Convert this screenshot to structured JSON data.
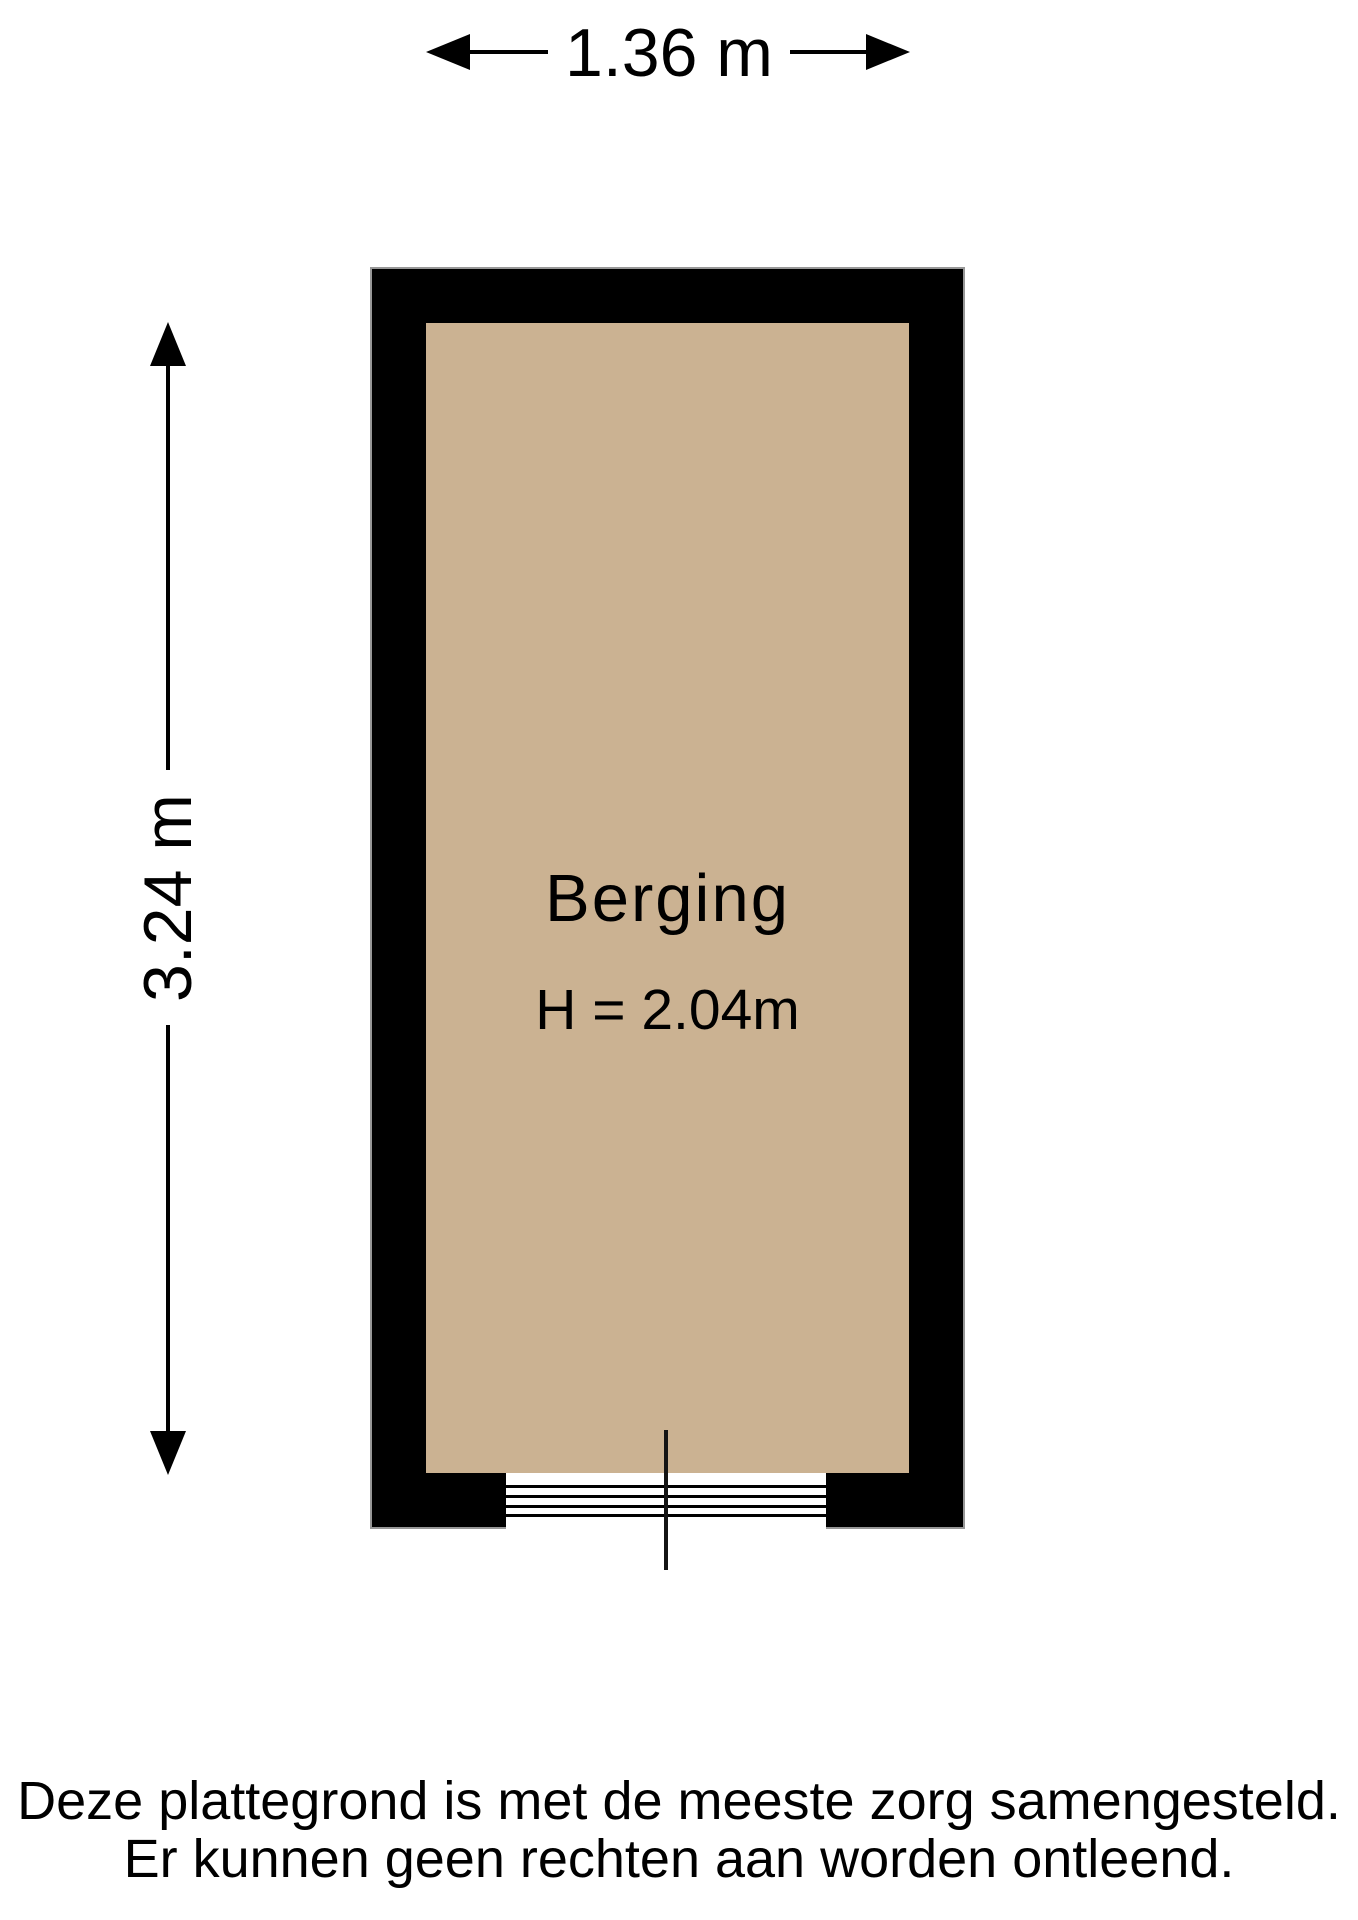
{
  "dimensions": {
    "width_label": "1.36 m",
    "height_label": "3.24 m"
  },
  "room": {
    "name": "Berging",
    "ceiling_height_label": "H = 2.04m",
    "wall_color": "#000000",
    "floor_color": "#cbb292",
    "line_color": "#000000"
  },
  "disclaimer": {
    "line1": "Deze plattegrond is met de meeste zorg samengesteld.",
    "line2": "Er kunnen geen rechten aan worden ontleend."
  }
}
